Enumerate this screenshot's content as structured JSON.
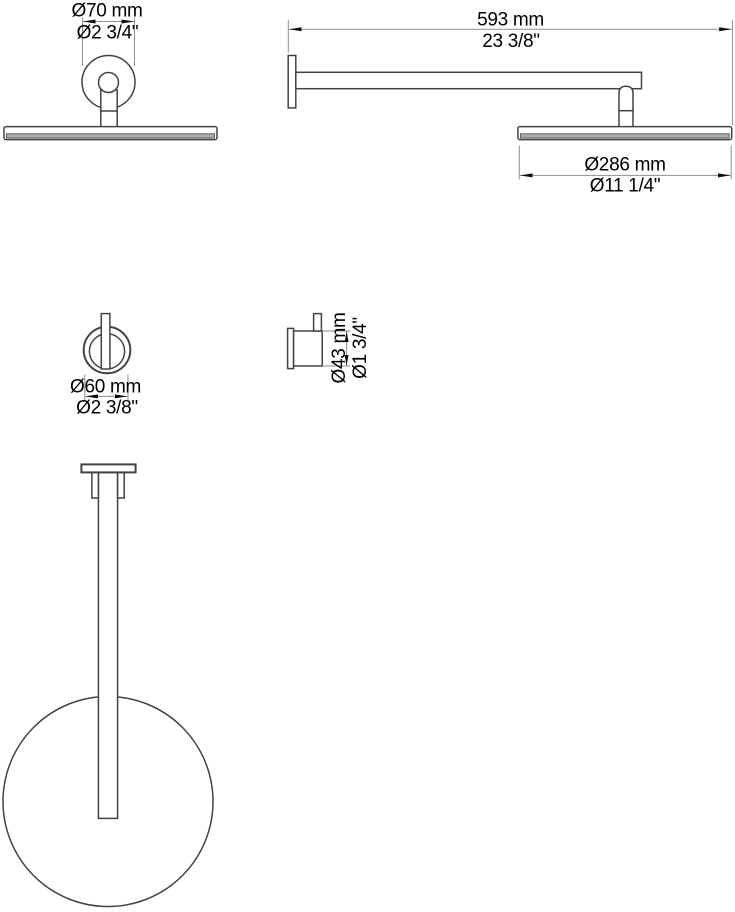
{
  "page": {
    "background": "#ffffff"
  },
  "colors": {
    "outline": "#424242",
    "dimension_line": "#8e8e8e",
    "arrowhead": "#0d0d0d",
    "label_text": "#000000",
    "spray_face_fill": "#ababab",
    "spray_face_edge": "#555555"
  },
  "views": {
    "ceiling_head_side": {
      "flange_dia_mm": "Ø70 mm",
      "flange_dia_in": "Ø2 3/4\""
    },
    "wall_arm_side": {
      "arm_reach_mm": "593 mm",
      "arm_reach_in": "23 3/8\"",
      "head_dia_mm": "Ø286 mm",
      "head_dia_in": "Ø11 1/4\""
    },
    "mount_front": {
      "flange_dia_mm": "Ø60 mm",
      "flange_dia_in": "Ø2 3/8\""
    },
    "mount_side": {
      "body_dia_mm": "Ø43 mm",
      "body_dia_in": "Ø1 3/4\""
    }
  }
}
